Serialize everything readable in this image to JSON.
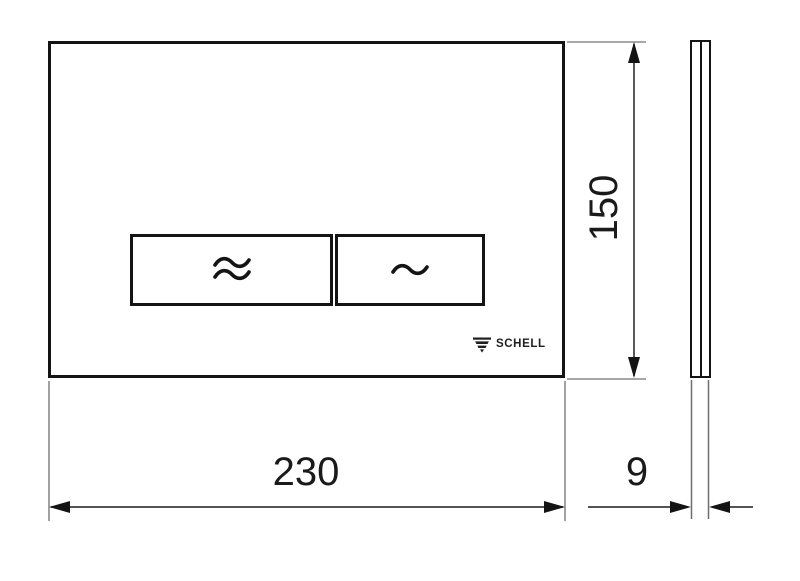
{
  "front_view": {
    "brand": "SCHELL",
    "brand_icon": "schell-funnel-icon",
    "buttons": {
      "large_button_icon": "double-wave-icon",
      "small_button_icon": "single-wave-icon"
    }
  },
  "side_view": {
    "description_icon": "plate-profile"
  },
  "dimensions": {
    "width": {
      "value": "230",
      "position": "bottom"
    },
    "height": {
      "value": "150",
      "position": "right",
      "rotated": true
    },
    "depth": {
      "value": "9",
      "position": "bottom-right"
    }
  },
  "colors": {
    "background": "#ffffff",
    "outline": "#141414",
    "dimension_line": "#3c3c3c",
    "extension_line": "#8a8a8a",
    "text": "#1a1a1a"
  }
}
